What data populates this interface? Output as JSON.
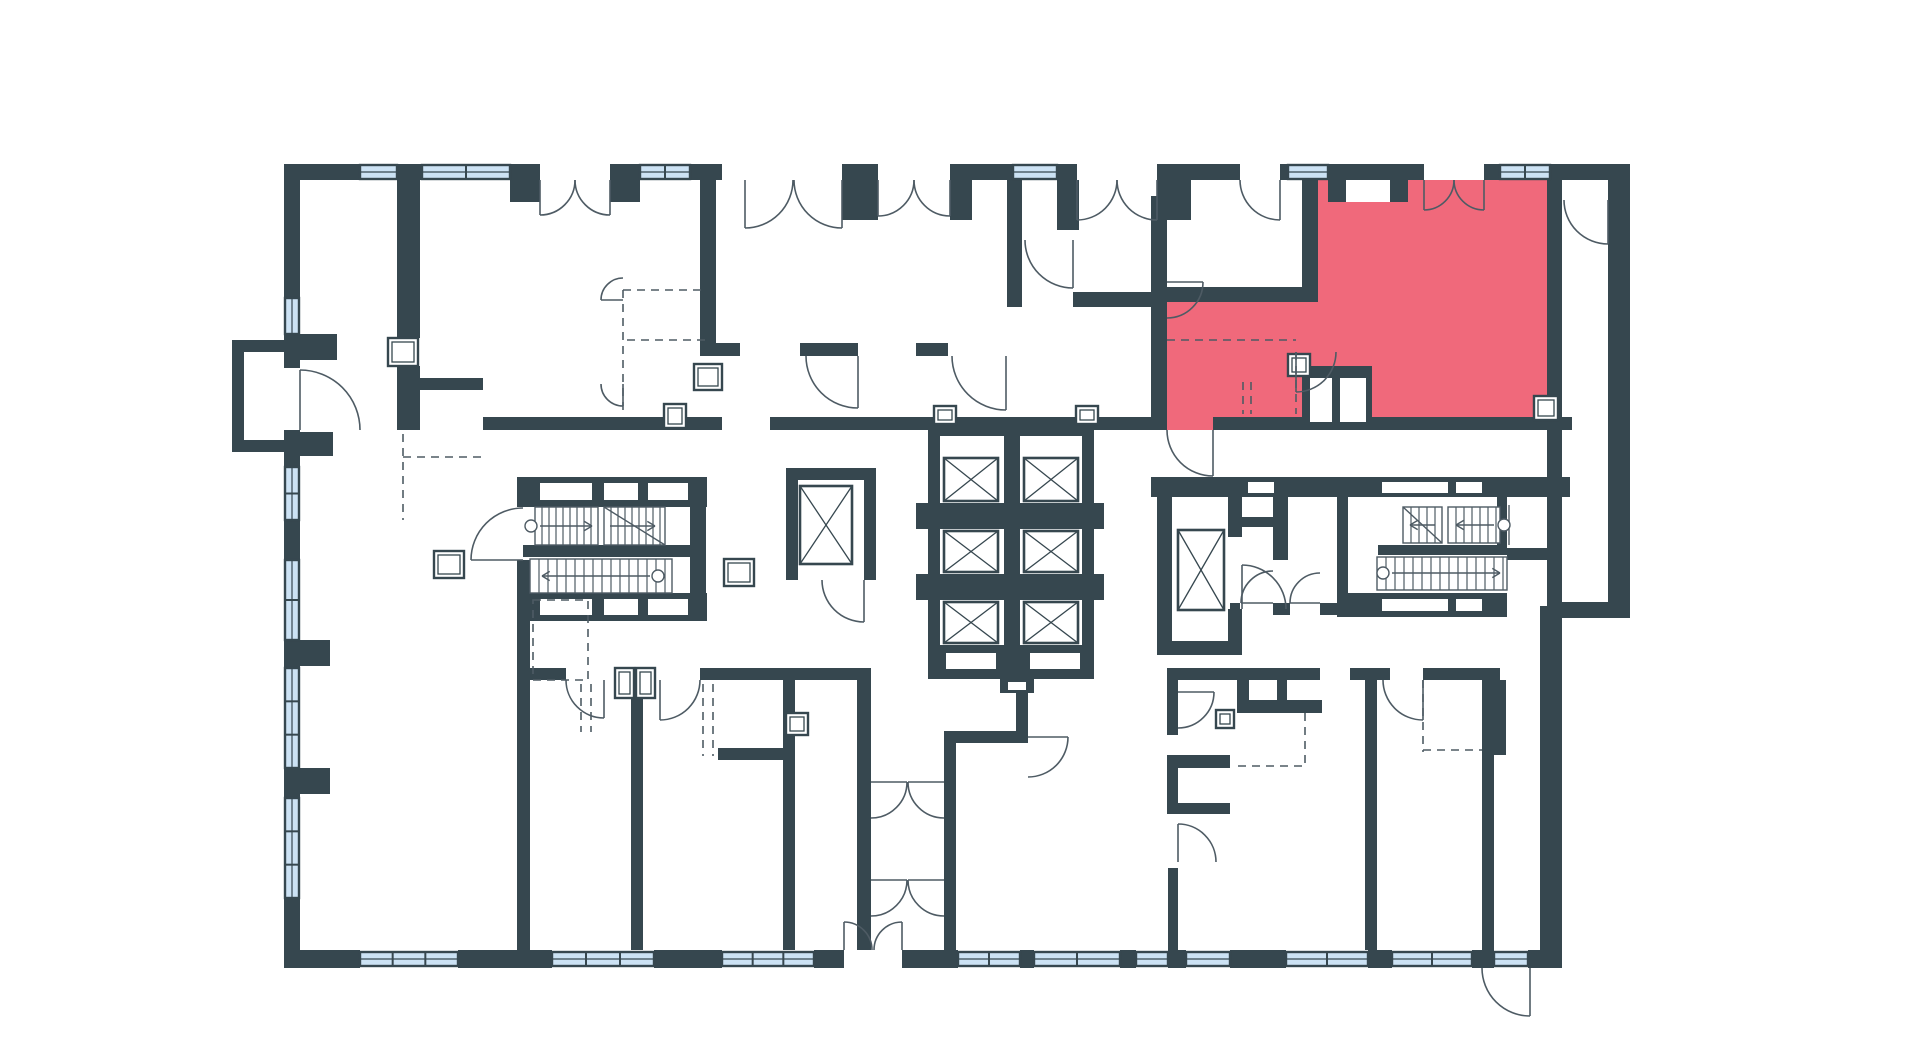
{
  "meta": {
    "view": "building-floor-plan",
    "description": "Residential floor plan with one apartment unit highlighted",
    "highlighted_units_count": 1
  },
  "canvas": {
    "width": 1920,
    "height": 1054,
    "background": "#FFFFFF"
  },
  "palette": {
    "wall": "#36474F",
    "window": "#CCE2F4",
    "line": "#4E5B64",
    "highlight": "#F0697B",
    "white": "#FFFFFF"
  },
  "plan": {
    "highlight_polygon": "1167,430 1167,302 1318,302 1318,180 1346,180 1346,202 1390,202 1390,180 1547,180 1547,430",
    "walls": [
      [
        284,
        164,
        76,
        16
      ],
      [
        397,
        164,
        25,
        16
      ],
      [
        510,
        164,
        30,
        16
      ],
      [
        510,
        180,
        30,
        22
      ],
      [
        610,
        164,
        30,
        16
      ],
      [
        610,
        180,
        30,
        22
      ],
      [
        690,
        164,
        32,
        16
      ],
      [
        842,
        164,
        36,
        16
      ],
      [
        842,
        180,
        36,
        40
      ],
      [
        950,
        164,
        63,
        16
      ],
      [
        950,
        180,
        22,
        40
      ],
      [
        1057,
        164,
        20,
        16
      ],
      [
        1057,
        180,
        22,
        50
      ],
      [
        1157,
        164,
        83,
        16
      ],
      [
        1280,
        164,
        8,
        16
      ],
      [
        1328,
        164,
        80,
        16
      ],
      [
        1328,
        180,
        18,
        22
      ],
      [
        1390,
        180,
        18,
        22
      ],
      [
        1408,
        164,
        16,
        16
      ],
      [
        1484,
        164,
        16,
        16
      ],
      [
        1550,
        164,
        80,
        16
      ],
      [
        284,
        180,
        16,
        118
      ],
      [
        284,
        334,
        16,
        34
      ],
      [
        300,
        334,
        37,
        26
      ],
      [
        284,
        430,
        16,
        37
      ],
      [
        300,
        432,
        33,
        24
      ],
      [
        284,
        520,
        16,
        40
      ],
      [
        284,
        640,
        16,
        28
      ],
      [
        300,
        640,
        30,
        26
      ],
      [
        284,
        768,
        16,
        30
      ],
      [
        300,
        768,
        30,
        26
      ],
      [
        284,
        898,
        16,
        70
      ],
      [
        232,
        340,
        52,
        12
      ],
      [
        232,
        340,
        12,
        112
      ],
      [
        232,
        440,
        52,
        12
      ],
      [
        397,
        180,
        23,
        158
      ],
      [
        397,
        366,
        23,
        64
      ],
      [
        403,
        378,
        80,
        12
      ],
      [
        483,
        417,
        239,
        13
      ],
      [
        770,
        417,
        240,
        13
      ],
      [
        1010,
        417,
        157,
        13
      ],
      [
        1213,
        417,
        359,
        13
      ],
      [
        700,
        180,
        16,
        176
      ],
      [
        700,
        343,
        40,
        13
      ],
      [
        800,
        343,
        58,
        13
      ],
      [
        916,
        343,
        32,
        13
      ],
      [
        1007,
        180,
        15,
        127
      ],
      [
        1073,
        292,
        94,
        15
      ],
      [
        1151,
        196,
        16,
        234
      ],
      [
        1157,
        287,
        161,
        15
      ],
      [
        1302,
        180,
        16,
        122
      ],
      [
        1157,
        180,
        34,
        40
      ],
      [
        1547,
        180,
        15,
        250
      ],
      [
        1547,
        430,
        15,
        176
      ],
      [
        1608,
        180,
        22,
        438
      ],
      [
        1562,
        602,
        68,
        16
      ],
      [
        1540,
        606,
        22,
        362
      ],
      [
        1302,
        366,
        70,
        64
      ],
      [
        928,
        424,
        164,
        12
      ],
      [
        928,
        424,
        12,
        255
      ],
      [
        1082,
        424,
        12,
        255
      ],
      [
        1004,
        424,
        16,
        255
      ],
      [
        928,
        503,
        164,
        26
      ],
      [
        928,
        574,
        164,
        26
      ],
      [
        928,
        645,
        164,
        34
      ],
      [
        1000,
        679,
        34,
        14
      ],
      [
        916,
        503,
        12,
        26
      ],
      [
        1092,
        503,
        12,
        26
      ],
      [
        916,
        574,
        12,
        26
      ],
      [
        1092,
        574,
        12,
        26
      ],
      [
        517,
        477,
        190,
        30
      ],
      [
        517,
        560,
        13,
        57
      ],
      [
        690,
        477,
        16,
        140
      ],
      [
        523,
        545,
        167,
        12
      ],
      [
        517,
        593,
        190,
        28
      ],
      [
        786,
        468,
        90,
        12
      ],
      [
        786,
        468,
        12,
        112
      ],
      [
        864,
        468,
        12,
        112
      ],
      [
        517,
        621,
        13,
        329
      ],
      [
        631,
        672,
        12,
        278
      ],
      [
        783,
        668,
        12,
        282
      ],
      [
        857,
        668,
        14,
        282
      ],
      [
        530,
        668,
        36,
        12
      ],
      [
        700,
        668,
        83,
        12
      ],
      [
        795,
        668,
        62,
        12
      ],
      [
        718,
        748,
        65,
        12
      ],
      [
        944,
        731,
        12,
        219
      ],
      [
        944,
        731,
        84,
        12
      ],
      [
        1016,
        645,
        12,
        98
      ],
      [
        1151,
        477,
        419,
        20
      ],
      [
        1157,
        497,
        15,
        158
      ],
      [
        1228,
        497,
        14,
        40
      ],
      [
        1228,
        609,
        14,
        46
      ],
      [
        1157,
        641,
        85,
        14
      ],
      [
        1273,
        497,
        15,
        63
      ],
      [
        1230,
        517,
        43,
        10
      ],
      [
        1230,
        603,
        10,
        12
      ],
      [
        1273,
        603,
        17,
        12
      ],
      [
        1320,
        603,
        17,
        12
      ],
      [
        1337,
        497,
        11,
        120
      ],
      [
        1378,
        545,
        129,
        10
      ],
      [
        1337,
        593,
        170,
        24
      ],
      [
        1497,
        497,
        10,
        48
      ],
      [
        1507,
        548,
        40,
        12
      ],
      [
        1167,
        668,
        153,
        12
      ],
      [
        1350,
        668,
        40,
        12
      ],
      [
        1423,
        668,
        77,
        12
      ],
      [
        1237,
        668,
        12,
        45
      ],
      [
        1237,
        700,
        85,
        13
      ],
      [
        1277,
        668,
        10,
        45
      ],
      [
        1167,
        680,
        11,
        55
      ],
      [
        1167,
        755,
        63,
        13
      ],
      [
        1167,
        768,
        11,
        35
      ],
      [
        1167,
        803,
        63,
        11
      ],
      [
        1168,
        868,
        10,
        82
      ],
      [
        1365,
        668,
        12,
        282
      ],
      [
        1482,
        668,
        12,
        282
      ],
      [
        1494,
        680,
        12,
        75
      ],
      [
        284,
        950,
        76,
        18
      ],
      [
        458,
        950,
        94,
        18
      ],
      [
        654,
        950,
        68,
        18
      ],
      [
        814,
        950,
        30,
        18
      ],
      [
        902,
        950,
        56,
        18
      ],
      [
        1020,
        950,
        14,
        18
      ],
      [
        1120,
        950,
        16,
        18
      ],
      [
        1168,
        950,
        18,
        18
      ],
      [
        1230,
        950,
        56,
        18
      ],
      [
        1368,
        950,
        24,
        18
      ],
      [
        1472,
        950,
        22,
        18
      ],
      [
        1528,
        950,
        34,
        18
      ]
    ],
    "windows_h": [
      [
        360,
        165,
        37,
        14
      ],
      [
        422,
        165,
        88,
        14
      ],
      [
        640,
        165,
        50,
        14
      ],
      [
        1013,
        165,
        44,
        14
      ],
      [
        1288,
        165,
        40,
        14
      ],
      [
        1500,
        165,
        50,
        14
      ],
      [
        360,
        952,
        98,
        14
      ],
      [
        552,
        952,
        102,
        14
      ],
      [
        722,
        952,
        92,
        14
      ],
      [
        958,
        952,
        62,
        14
      ],
      [
        1034,
        952,
        86,
        14
      ],
      [
        1136,
        952,
        32,
        14
      ],
      [
        1186,
        952,
        44,
        14
      ],
      [
        1286,
        952,
        82,
        14
      ],
      [
        1392,
        952,
        80,
        14
      ],
      [
        1494,
        952,
        34,
        14
      ]
    ],
    "windows_v": [
      [
        285,
        298,
        14,
        36
      ],
      [
        285,
        467,
        14,
        53
      ],
      [
        285,
        560,
        14,
        80
      ],
      [
        285,
        668,
        14,
        100
      ],
      [
        285,
        798,
        14,
        100
      ]
    ],
    "white_slots": [
      [
        946,
        653,
        50,
        16
      ],
      [
        1030,
        653,
        50,
        16
      ],
      [
        1008,
        682,
        18,
        8
      ],
      [
        540,
        483,
        52,
        17
      ],
      [
        604,
        483,
        34,
        17
      ],
      [
        648,
        483,
        40,
        17
      ],
      [
        540,
        599,
        52,
        16
      ],
      [
        604,
        599,
        34,
        16
      ],
      [
        648,
        599,
        40,
        16
      ],
      [
        1248,
        482,
        26,
        11
      ],
      [
        1382,
        482,
        66,
        11
      ],
      [
        1456,
        482,
        26,
        11
      ],
      [
        1382,
        599,
        66,
        12
      ],
      [
        1456,
        599,
        26,
        12
      ],
      [
        1310,
        378,
        22,
        44
      ],
      [
        1340,
        378,
        26,
        44
      ]
    ],
    "fixture_boxes": [
      [
        388,
        338,
        30,
        28
      ],
      [
        434,
        551,
        30,
        27
      ],
      [
        724,
        559,
        30,
        27
      ],
      [
        786,
        713,
        22,
        22
      ],
      [
        664,
        404,
        22,
        24
      ],
      [
        694,
        364,
        28,
        26
      ],
      [
        1216,
        710,
        18,
        18
      ],
      [
        1288,
        354,
        22,
        22
      ],
      [
        934,
        406,
        22,
        18
      ],
      [
        1076,
        406,
        22,
        18
      ],
      [
        615,
        668,
        19,
        30
      ],
      [
        636,
        668,
        19,
        30
      ],
      [
        1534,
        396,
        24,
        24
      ]
    ],
    "elevators": [
      [
        944,
        458,
        54,
        43
      ],
      [
        1024,
        458,
        54,
        43
      ],
      [
        944,
        531,
        54,
        41
      ],
      [
        1024,
        531,
        54,
        41
      ],
      [
        944,
        602,
        54,
        41
      ],
      [
        1024,
        602,
        54,
        41
      ],
      [
        800,
        486,
        52,
        78
      ],
      [
        1178,
        530,
        46,
        80
      ]
    ],
    "stairs": [
      {
        "x": 535,
        "y": 507,
        "w": 63,
        "h": 38,
        "step": 7,
        "circle": [
          531,
          526
        ],
        "arrow": [
          540,
          526,
          592,
          526
        ]
      },
      {
        "x": 604,
        "y": 507,
        "w": 61,
        "h": 38,
        "step": 7,
        "diag": [
          604,
          507,
          665,
          545
        ],
        "arrow": [
          610,
          526,
          655,
          526
        ]
      },
      {
        "x": 530,
        "y": 559,
        "w": 142,
        "h": 34,
        "step": 9,
        "circle": [
          658,
          576
        ],
        "arrow": [
          650,
          576,
          542,
          576
        ]
      },
      {
        "x": 1403,
        "y": 507,
        "w": 39,
        "h": 36,
        "step": 8,
        "diag": [
          1403,
          507,
          1442,
          543
        ],
        "arrow": [
          1435,
          525,
          1410,
          525
        ]
      },
      {
        "x": 1448,
        "y": 507,
        "w": 52,
        "h": 36,
        "step": 8,
        "circle": [
          1504,
          525
        ],
        "arrow": [
          1494,
          525,
          1456,
          525
        ],
        "guard": [
          1509,
          505,
          1509,
          545
        ]
      },
      {
        "x": 1377,
        "y": 557,
        "w": 130,
        "h": 33,
        "step": 9,
        "circle": [
          1383,
          573
        ],
        "arrow": [
          1392,
          573,
          1500,
          573
        ]
      }
    ],
    "doors": [
      [
        300,
        430,
        60,
        270,
        0
      ],
      [
        1213,
        430,
        46,
        90,
        180
      ],
      [
        858,
        356,
        52,
        90,
        180
      ],
      [
        1006,
        356,
        54,
        90,
        180
      ],
      [
        1073,
        240,
        48,
        90,
        180
      ],
      [
        540,
        180,
        35,
        90,
        0
      ],
      [
        610,
        180,
        35,
        90,
        180
      ],
      [
        878,
        180,
        36,
        90,
        0
      ],
      [
        950,
        180,
        36,
        90,
        180
      ],
      [
        745,
        180,
        48,
        90,
        0
      ],
      [
        842,
        180,
        48,
        90,
        180
      ],
      [
        1077,
        180,
        40,
        90,
        0
      ],
      [
        1157,
        180,
        40,
        90,
        180
      ],
      [
        1280,
        180,
        40,
        90,
        180
      ],
      [
        1424,
        180,
        30,
        90,
        0
      ],
      [
        1484,
        180,
        30,
        90,
        180
      ],
      [
        1608,
        200,
        44,
        90,
        180
      ],
      [
        1167,
        282,
        36,
        0,
        90
      ],
      [
        1296,
        352,
        40,
        90,
        0
      ],
      [
        523,
        560,
        52,
        180,
        270
      ],
      [
        864,
        580,
        42,
        90,
        180
      ],
      [
        604,
        680,
        38,
        90,
        180
      ],
      [
        660,
        680,
        40,
        90,
        0
      ],
      [
        871,
        782,
        36,
        0,
        90
      ],
      [
        944,
        782,
        36,
        180,
        90
      ],
      [
        871,
        880,
        36,
        0,
        90
      ],
      [
        944,
        880,
        36,
        180,
        90
      ],
      [
        1028,
        737,
        40,
        0,
        90
      ],
      [
        1242,
        609,
        44,
        270,
        0
      ],
      [
        1273,
        603,
        32,
        180,
        270
      ],
      [
        1320,
        603,
        30,
        180,
        270
      ],
      [
        1423,
        680,
        40,
        90,
        180
      ],
      [
        1178,
        692,
        36,
        0,
        90
      ],
      [
        1178,
        862,
        38,
        270,
        0
      ],
      [
        844,
        950,
        28,
        270,
        0
      ],
      [
        902,
        950,
        28,
        270,
        180
      ],
      [
        1530,
        968,
        48,
        90,
        180
      ],
      [
        623,
        300,
        22,
        180,
        270
      ],
      [
        623,
        384,
        22,
        90,
        180
      ]
    ],
    "dashes": [
      [
        623,
        290,
        705,
        290
      ],
      [
        627,
        340,
        705,
        340
      ],
      [
        623,
        290,
        623,
        415
      ],
      [
        403,
        434,
        403,
        520
      ],
      [
        403,
        457,
        483,
        457
      ],
      [
        1167,
        340,
        1296,
        340
      ],
      [
        1296,
        352,
        1296,
        414
      ],
      [
        1243,
        382,
        1243,
        414
      ],
      [
        1251,
        382,
        1251,
        414
      ],
      [
        581,
        684,
        581,
        732
      ],
      [
        591,
        684,
        591,
        732
      ],
      [
        703,
        684,
        703,
        756
      ],
      [
        713,
        684,
        713,
        756
      ],
      [
        1238,
        766,
        1307,
        766
      ],
      [
        1305,
        713,
        1305,
        766
      ],
      [
        1423,
        680,
        1423,
        752
      ],
      [
        1423,
        750,
        1482,
        750
      ]
    ],
    "dash_rects": [
      [
        533,
        600,
        55,
        80
      ]
    ]
  }
}
